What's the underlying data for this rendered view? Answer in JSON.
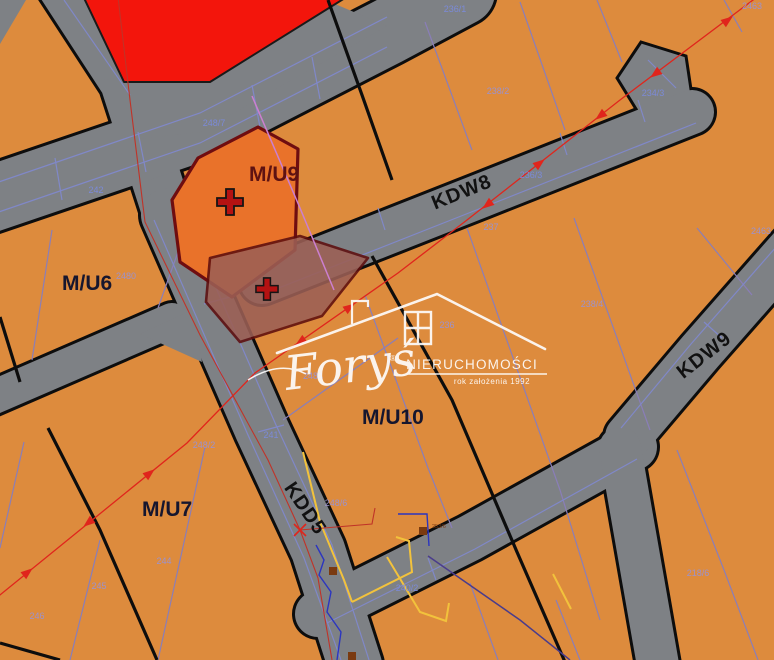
{
  "map": {
    "size": {
      "w": 774,
      "h": 660
    },
    "colors": {
      "parcel": "#DD8B3D",
      "road": "#7E8185",
      "road_edge": "#0D0D0D",
      "red_zone": "#F3150C",
      "mu9": "#E9722A",
      "mu9_border": "#6F0D10",
      "overlay": "#9C5F55",
      "overlay_border": "#5E0E0E",
      "boundary": "#0D0D0D",
      "parcel_line": "#8A7EB8",
      "road_line": "#8088C8",
      "num_road": "#7B8AD8",
      "num_parcel": "#9C92CC",
      "zone_label": "#16162E",
      "mu9_label": "#5E1212",
      "road_label": "#111111",
      "red_line": "#E0251C",
      "red_line_b": "#C03328",
      "magenta": "#CC7FD0",
      "yellow": "#F2C23C",
      "blue_util": "#2B35C0",
      "purple_util": "#4A3C8C",
      "brown": "#7A3A10",
      "cross_fill": "#B51212",
      "cross_stroke": "#151515",
      "watermark": "#FFFFFF"
    },
    "roads": [
      {
        "name": "road-north-stub",
        "pts": [
          [
            52,
            -30
          ],
          [
            125,
            82
          ],
          [
            168,
            215
          ]
        ],
        "w": 50
      },
      {
        "name": "road-kdd5",
        "pts": [
          [
            168,
            215
          ],
          [
            262,
            430
          ],
          [
            318,
            550
          ],
          [
            355,
            665
          ]
        ],
        "w": 54
      },
      {
        "name": "road-main-west",
        "pts": [
          [
            -12,
            200
          ],
          [
            200,
            128
          ],
          [
            387,
            32
          ],
          [
            462,
            -8
          ]
        ],
        "w": 66
      },
      {
        "name": "road-kdw8",
        "pts": [
          [
            262,
            282
          ],
          [
            480,
            196
          ],
          [
            692,
            112
          ]
        ],
        "w": 44
      },
      {
        "name": "road-mid",
        "pts": [
          [
            -8,
            398
          ],
          [
            172,
            320
          ]
        ],
        "w": 34
      },
      {
        "name": "road-r5",
        "pts": [
          [
            318,
            614
          ],
          [
            470,
            538
          ],
          [
            634,
            447
          ]
        ],
        "w": 46
      },
      {
        "name": "road-kdw9",
        "pts": [
          [
            802,
            236
          ],
          [
            700,
            352
          ],
          [
            628,
            437
          ]
        ],
        "w": 46
      },
      {
        "name": "road-kdw9-south",
        "pts": [
          [
            620,
            448
          ],
          [
            658,
            665
          ]
        ],
        "w": 42
      }
    ],
    "patches": [
      [
        [
          95,
          80
        ],
        [
          210,
          72
        ],
        [
          335,
          4
        ],
        [
          387,
          26
        ],
        [
          200,
          132
        ],
        [
          130,
          140
        ]
      ],
      [
        [
          140,
          334
        ],
        [
          192,
          310
        ],
        [
          202,
          362
        ]
      ]
    ],
    "bulge": [
      [
        641,
        42
      ],
      [
        686,
        56
      ],
      [
        695,
        116
      ],
      [
        655,
        140
      ],
      [
        617,
        78
      ]
    ],
    "zones": [
      {
        "name": "zone-red",
        "pts": [
          [
            84,
            -2
          ],
          [
            345,
            -2
          ],
          [
            210,
            82
          ],
          [
            124,
            82
          ]
        ],
        "fill": "#F3150C",
        "stroke": "#1A1A1A",
        "sw": 2,
        "opacity": 1
      },
      {
        "name": "zone-mu9",
        "pts": [
          [
            198,
            158
          ],
          [
            258,
            127
          ],
          [
            298,
            149
          ],
          [
            295,
            250
          ],
          [
            232,
            297
          ],
          [
            180,
            262
          ],
          [
            172,
            200
          ]
        ],
        "fill": "#E9722A",
        "stroke": "#6F0D10",
        "sw": 3.2,
        "opacity": 1
      },
      {
        "name": "zone-overlay",
        "pts": [
          [
            210,
            258
          ],
          [
            300,
            236
          ],
          [
            368,
            258
          ],
          [
            322,
            316
          ],
          [
            240,
            342
          ],
          [
            206,
            302
          ]
        ],
        "fill": "#9C5F55",
        "stroke": "#5E0E0E",
        "sw": 2.6,
        "opacity": 0.88
      }
    ],
    "black_lines": [
      [
        [
          0,
          317
        ],
        [
          20,
          382
        ]
      ],
      [
        [
          48,
          428
        ],
        [
          100,
          530
        ],
        [
          157,
          660
        ]
      ],
      [
        [
          372,
          256
        ],
        [
          452,
          400
        ],
        [
          517,
          552
        ],
        [
          565,
          662
        ]
      ],
      [
        [
          328,
          0
        ],
        [
          362,
          95
        ],
        [
          392,
          180
        ]
      ],
      [
        [
          0,
          643
        ],
        [
          60,
          660
        ]
      ]
    ],
    "parcel_lines": [
      [
        [
          202,
          0
        ],
        [
          222,
          55
        ]
      ],
      [
        [
          425,
          22
        ],
        [
          472,
          150
        ]
      ],
      [
        [
          520,
          2
        ],
        [
          565,
          130
        ]
      ],
      [
        [
          597,
          0
        ],
        [
          622,
          62
        ]
      ],
      [
        [
          724,
          0
        ],
        [
          742,
          32
        ]
      ],
      [
        [
          467,
          228
        ],
        [
          560,
          490
        ],
        [
          600,
          620
        ]
      ],
      [
        [
          574,
          218
        ],
        [
          650,
          430
        ]
      ],
      [
        [
          697,
          228
        ],
        [
          752,
          295
        ]
      ],
      [
        [
          365,
          295
        ],
        [
          428,
          468
        ],
        [
          452,
          528
        ]
      ],
      [
        [
          283,
          420
        ],
        [
          398,
          338
        ]
      ],
      [
        [
          52,
          230
        ],
        [
          32,
          360
        ]
      ],
      [
        [
          178,
          252
        ],
        [
          158,
          308
        ]
      ],
      [
        [
          24,
          442
        ],
        [
          0,
          548
        ]
      ],
      [
        [
          100,
          540
        ],
        [
          70,
          660
        ]
      ],
      [
        [
          205,
          447
        ],
        [
          158,
          660
        ]
      ],
      [
        [
          470,
          583
        ],
        [
          498,
          660
        ]
      ],
      [
        [
          556,
          600
        ],
        [
          580,
          660
        ]
      ],
      [
        [
          677,
          450
        ],
        [
          724,
          570
        ],
        [
          758,
          660
        ]
      ]
    ],
    "road_lines": [
      [
        [
          -10,
          185
        ],
        [
          200,
          113
        ],
        [
          387,
          17
        ]
      ],
      [
        [
          -10,
          215
        ],
        [
          200,
          143
        ],
        [
          387,
          47
        ]
      ],
      [
        [
          55,
          158
        ],
        [
          62,
          200
        ]
      ],
      [
        [
          138,
          132
        ],
        [
          146,
          172
        ]
      ],
      [
        [
          252,
          85
        ],
        [
          260,
          127
        ]
      ],
      [
        [
          312,
          57
        ],
        [
          320,
          99
        ]
      ],
      [
        [
          266,
          293
        ],
        [
          484,
          207
        ],
        [
          696,
          123
        ]
      ],
      [
        [
          378,
          208
        ],
        [
          385,
          230
        ]
      ],
      [
        [
          560,
          133
        ],
        [
          567,
          155
        ]
      ],
      [
        [
          638,
          100
        ],
        [
          645,
          122
        ]
      ],
      [
        [
          182,
          210
        ],
        [
          276,
          425
        ],
        [
          332,
          545
        ],
        [
          369,
          660
        ]
      ],
      [
        [
          154,
          220
        ],
        [
          248,
          435
        ],
        [
          304,
          558
        ],
        [
          341,
          660
        ]
      ],
      [
        [
          204,
          304
        ],
        [
          230,
          297
        ]
      ],
      [
        [
          258,
          432
        ],
        [
          284,
          425
        ]
      ],
      [
        [
          327,
          623
        ],
        [
          475,
          549
        ],
        [
          637,
          459
        ]
      ],
      [
        [
          428,
          558
        ],
        [
          436,
          580
        ]
      ],
      [
        [
          791,
          230
        ],
        [
          691,
          344
        ],
        [
          621,
          428
        ]
      ],
      [
        [
          704,
          322
        ],
        [
          722,
          338
        ]
      ],
      [
        [
          64,
          0
        ],
        [
          130,
          95
        ]
      ],
      [
        [
          648,
          60
        ],
        [
          676,
          88
        ]
      ]
    ],
    "red_lines": {
      "a": {
        "pts": [
          [
            757,
            -3
          ],
          [
            620,
            100
          ],
          [
            467,
            220
          ],
          [
            398,
            273
          ],
          [
            255,
            373
          ],
          [
            187,
            443
          ],
          [
            -5,
            599
          ]
        ],
        "arrows": [
          {
            "x": 728,
            "y": 20,
            "a": -37
          },
          {
            "x": 655,
            "y": 74,
            "a": 143
          },
          {
            "x": 600,
            "y": 116,
            "a": 142
          },
          {
            "x": 540,
            "y": 163,
            "a": -38
          },
          {
            "x": 487,
            "y": 205,
            "a": 142
          },
          {
            "x": 350,
            "y": 307,
            "a": -35
          },
          {
            "x": 300,
            "y": 342,
            "a": 145
          },
          {
            "x": 150,
            "y": 473,
            "a": -39
          },
          {
            "x": 88,
            "y": 523,
            "a": 141
          },
          {
            "x": 28,
            "y": 572,
            "a": -39
          }
        ]
      },
      "b": {
        "pts": [
          [
            118,
            -3
          ],
          [
            130,
            100
          ],
          [
            145,
            222
          ],
          [
            200,
            335
          ],
          [
            268,
            460
          ],
          [
            300,
            530
          ],
          [
            318,
            578
          ],
          [
            332,
            660
          ]
        ],
        "x_marker": {
          "x": 300,
          "y": 530
        },
        "branch": [
          [
            300,
            530
          ],
          [
            372,
            524
          ],
          [
            375,
            508
          ]
        ]
      }
    },
    "magenta_line": [
      [
        252,
        96
      ],
      [
        300,
        208
      ],
      [
        334,
        290
      ]
    ],
    "utilities": {
      "yellow": [
        [
          [
            303,
            452
          ],
          [
            320,
            522
          ],
          [
            344,
            580
          ],
          [
            352,
            602
          ]
        ],
        [
          [
            352,
            602
          ],
          [
            412,
            572
          ],
          [
            409,
            541
          ],
          [
            396,
            537
          ]
        ],
        [
          [
            387,
            557
          ],
          [
            420,
            612
          ],
          [
            446,
            621
          ],
          [
            449,
            603
          ]
        ],
        [
          [
            553,
            574
          ],
          [
            571,
            609
          ]
        ]
      ],
      "blue": [
        [
          [
            316,
            545
          ],
          [
            324,
            560
          ],
          [
            319,
            575
          ],
          [
            331,
            592
          ],
          [
            327,
            612
          ],
          [
            341,
            632
          ],
          [
            337,
            660
          ]
        ],
        [
          [
            398,
            514
          ],
          [
            427,
            514
          ],
          [
            429,
            546
          ]
        ]
      ],
      "purple": [
        [
          [
            428,
            556
          ],
          [
            520,
            620
          ],
          [
            570,
            660
          ]
        ]
      ],
      "brown_squares": [
        [
          423,
          531
        ],
        [
          333,
          571
        ],
        [
          352,
          656
        ]
      ],
      "brown_label": {
        "text": "253/6",
        "x": 432,
        "y": 528
      }
    },
    "crosses": [
      {
        "x": 230,
        "y": 202,
        "s": 1
      },
      {
        "x": 267,
        "y": 289,
        "s": 0.85
      }
    ],
    "parcel_numbers": [
      {
        "text": "236/1",
        "x": 455,
        "y": 12,
        "on": "road"
      },
      {
        "text": "2463",
        "x": 752,
        "y": 9,
        "on": "parcel"
      },
      {
        "text": "248/7",
        "x": 214,
        "y": 126,
        "on": "road"
      },
      {
        "text": "242",
        "x": 96,
        "y": 193,
        "on": "road"
      },
      {
        "text": "238/2",
        "x": 498,
        "y": 94,
        "on": "parcel"
      },
      {
        "text": "234/3",
        "x": 653,
        "y": 96,
        "on": "road"
      },
      {
        "text": "236/3",
        "x": 531,
        "y": 178,
        "on": "road"
      },
      {
        "text": "237",
        "x": 491,
        "y": 230,
        "on": "parcel"
      },
      {
        "text": "2463",
        "x": 761,
        "y": 234,
        "on": "parcel"
      },
      {
        "text": "2480",
        "x": 126,
        "y": 279,
        "on": "parcel"
      },
      {
        "text": "238/4",
        "x": 592,
        "y": 307,
        "on": "parcel"
      },
      {
        "text": "236",
        "x": 447,
        "y": 328,
        "on": "parcel"
      },
      {
        "text": "2484",
        "x": 313,
        "y": 379,
        "on": "parcel"
      },
      {
        "text": "241",
        "x": 271,
        "y": 438,
        "on": "road"
      },
      {
        "text": "248/2",
        "x": 204,
        "y": 448,
        "on": "parcel"
      },
      {
        "text": "248/6",
        "x": 336,
        "y": 506,
        "on": "parcel"
      },
      {
        "text": "244",
        "x": 164,
        "y": 564,
        "on": "parcel"
      },
      {
        "text": "245",
        "x": 99,
        "y": 589,
        "on": "parcel"
      },
      {
        "text": "246",
        "x": 37,
        "y": 619,
        "on": "parcel"
      },
      {
        "text": "240/2",
        "x": 407,
        "y": 591,
        "on": "road"
      },
      {
        "text": "218/6",
        "x": 698,
        "y": 576,
        "on": "parcel"
      }
    ],
    "zone_labels": [
      {
        "text": "M/U6",
        "x": 62,
        "y": 290,
        "type": "zone"
      },
      {
        "text": "M/U9",
        "x": 249,
        "y": 181,
        "type": "mu9"
      },
      {
        "text": "M/U7",
        "x": 142,
        "y": 516,
        "type": "zone"
      },
      {
        "text": "M/U10",
        "x": 362,
        "y": 424,
        "type": "zone"
      }
    ],
    "road_labels": [
      {
        "text": "KDW8",
        "x": 464,
        "y": 198,
        "rot": -22
      },
      {
        "text": "KDW9",
        "x": 708,
        "y": 360,
        "rot": -38
      },
      {
        "text": "KDD5",
        "x": 300,
        "y": 512,
        "rot": 56
      }
    ],
    "watermark": {
      "brand": "Foryś",
      "reg": "®",
      "title": "NIERUCHOMOŚCI",
      "subtitle": "rok założenia 1992"
    }
  }
}
